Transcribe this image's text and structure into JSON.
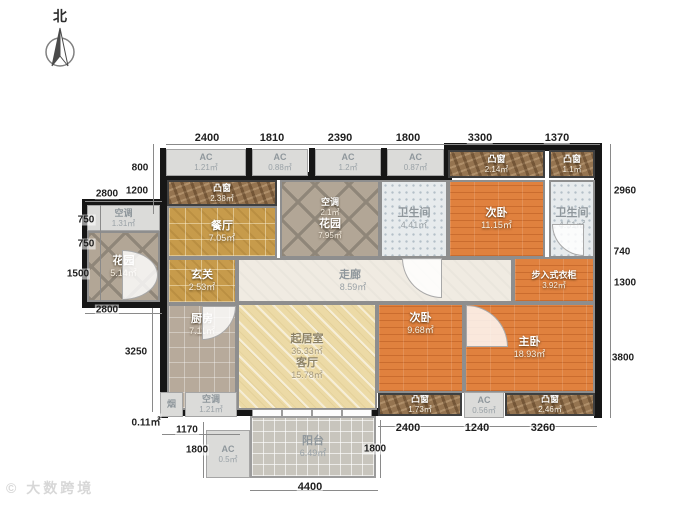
{
  "compass": {
    "label": "北"
  },
  "watermark": {
    "text": "© 大数跨境"
  },
  "rooms": {
    "dining": {
      "name": "餐厅",
      "area": "7.05㎡"
    },
    "entry": {
      "name": "玄关",
      "area": "2.53㎡"
    },
    "kitchen": {
      "name": "厨房",
      "area": "7.11㎡"
    },
    "living": {
      "name": "起居室",
      "area": "36.33㎡",
      "name2": "客厅",
      "area2": "15.78㎡"
    },
    "corridor": {
      "name": "走廊",
      "area": "8.59㎡"
    },
    "garden_top": {
      "name": "花园",
      "area": "7.95㎡",
      "ac_label": "空调",
      "ac_area": "2.1㎡"
    },
    "garden_left": {
      "name": "花园",
      "area": "5.14㎡"
    },
    "ac_left": {
      "name": "空调",
      "area": "1.31㎡"
    },
    "bath1": {
      "name": "卫生间",
      "area": "4.41㎡"
    },
    "bed1": {
      "name": "次卧",
      "area": "11.15㎡"
    },
    "bath2": {
      "name": "卫生间",
      "area": "4.51㎡"
    },
    "closet": {
      "name": "步入式衣柜",
      "area": "3.92㎡"
    },
    "bed2": {
      "name": "次卧",
      "area": "9.68㎡"
    },
    "master": {
      "name": "主卧",
      "area": "18.93㎡"
    },
    "balcony": {
      "name": "阳台",
      "area": "6.49㎡"
    },
    "chimney": {
      "name": "烟",
      "area": "0.11㎡"
    },
    "ac_bottom": {
      "name": "空调",
      "area": "1.21㎡"
    }
  },
  "bay_windows": [
    {
      "name": "凸窗",
      "area": "2.38㎡"
    },
    {
      "name": "凸窗",
      "area": "2.14㎡"
    },
    {
      "name": "凸窗",
      "area": "1.1㎡"
    },
    {
      "name": "凸窗",
      "area": "1.73㎡"
    },
    {
      "name": "凸窗",
      "area": "2.46㎡"
    }
  ],
  "ac_units": [
    {
      "label": "AC",
      "area": "1.21㎡"
    },
    {
      "label": "AC",
      "area": "0.88㎡"
    },
    {
      "label": "AC",
      "area": "1.2㎡"
    },
    {
      "label": "AC",
      "area": "0.87㎡"
    },
    {
      "label": "AC",
      "area": "0.56㎡"
    },
    {
      "label": "AC",
      "area": "0.5㎡"
    }
  ],
  "dims": {
    "top": [
      "2400",
      "1810",
      "2390",
      "1800",
      "3300",
      "1370"
    ],
    "left": [
      "800",
      "1200",
      "2800",
      "750",
      "750",
      "1500",
      "2800",
      "3250",
      "1170",
      "1800"
    ],
    "right": [
      "2960",
      "740",
      "1300",
      "3800"
    ],
    "bottom": [
      "2400",
      "1240",
      "3260",
      "1800",
      "4400"
    ]
  }
}
